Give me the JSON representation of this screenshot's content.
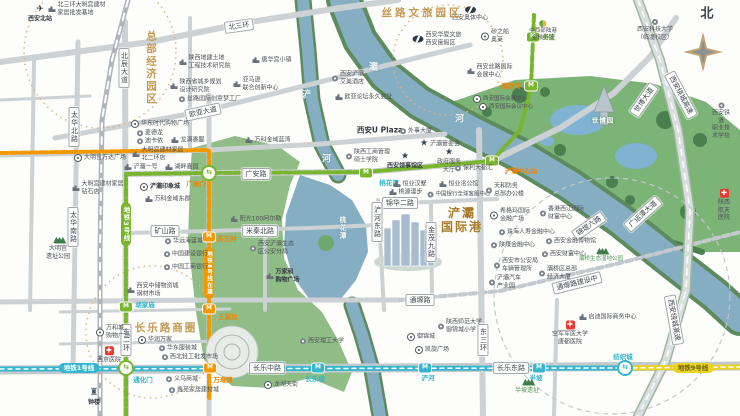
{
  "map": {
    "title_labels": {
      "hq": "总部经济园区",
      "silk": "丝路文旅园区",
      "port": "浐灞\n国际港",
      "changle": "长乐路商圈",
      "expo": "世博园",
      "north": "北"
    },
    "colors": {
      "gold": "#c49a55",
      "port_gold": "#a87b28",
      "line1": "#36b6ce",
      "line3": "#79b52d",
      "line8": "#f39800",
      "line9": "#ead31d",
      "teal": "#2eb4c9",
      "orange": "#f08300",
      "green_text": "#4f9552"
    },
    "metro_lines": [
      {
        "name": "地铁1号线",
        "color": "#36b6ce",
        "fg": "#fff",
        "dash": false,
        "w": 5,
        "path": [
          [
            0,
            369
          ],
          [
            625,
            368
          ]
        ],
        "pill": {
          "x": 79,
          "y": 368
        }
      },
      {
        "name": "地铁9号线",
        "color": "#ead31d",
        "fg": "#6a6014",
        "dash": false,
        "w": 5,
        "path": [
          [
            625,
            368
          ],
          [
            740,
            367
          ]
        ],
        "pill": {
          "x": 693,
          "y": 368
        }
      },
      {
        "name": "地铁3号线",
        "color": "#79b52d",
        "fg": "#fff",
        "dash": true,
        "w": 4,
        "path": [
          [
            126,
            416
          ],
          [
            126,
            174
          ],
          [
            209,
            173
          ],
          [
            366,
            172
          ],
          [
            492,
            161
          ],
          [
            520,
            130
          ],
          [
            531,
            87
          ],
          [
            534,
            15
          ]
        ],
        "pill": {
          "x": 126,
          "y": 224,
          "vert": true
        }
      },
      {
        "name": "地铁8号线在建",
        "color": "#f39800",
        "fg": "#fff",
        "dash": true,
        "w": 4,
        "path": [
          [
            0,
            153
          ],
          [
            209,
            150
          ],
          [
            209,
            398
          ]
        ],
        "pill": {
          "x": 209,
          "y": 273,
          "vert": true,
          "fs": 5.5
        }
      }
    ],
    "stations": [
      {
        "x": 126,
        "y": 368,
        "kind": "x",
        "color": "#79b52d",
        "label": "通化门",
        "lx": 143,
        "ly": 379,
        "lc": "#2eb4c9"
      },
      {
        "x": 126,
        "y": 307,
        "kind": "m",
        "color": "#79b52d",
        "label": "胡家庙",
        "lx": 145,
        "ly": 304,
        "lc": "#2eb4c9"
      },
      {
        "x": 209,
        "y": 173,
        "kind": "x",
        "color": "#79b52d",
        "label": "广泰门",
        "lx": 196,
        "ly": 183,
        "lc": "#f08300"
      },
      {
        "x": 366,
        "y": 173,
        "kind": "m",
        "color": "#79b52d",
        "label": "桃花潭",
        "lx": 389,
        "ly": 182,
        "lc": "#2eb4c9"
      },
      {
        "x": 492,
        "y": 161,
        "kind": "m",
        "color": "#79b52d",
        "label": "浐灞中心站",
        "lx": 521,
        "ly": 170,
        "lc": "#f08300"
      },
      {
        "x": 531,
        "y": 86,
        "kind": "m",
        "color": "#79b52d",
        "label": "香湖湾",
        "lx": 511,
        "ly": 85,
        "lc": "#f08300"
      },
      {
        "x": 533,
        "y": 37,
        "kind": "m",
        "color": "#79b52d",
        "label": "务庄",
        "lx": 549,
        "ly": 36,
        "lc": "#67a23c"
      },
      {
        "x": 209,
        "y": 237,
        "kind": "m",
        "color": "#f39800",
        "label": "苏王村",
        "lx": 227,
        "ly": 238,
        "lc": "#f08300"
      },
      {
        "x": 209,
        "y": 309,
        "kind": "m",
        "color": "#f39800",
        "label": "王家坟",
        "lx": 228,
        "ly": 316,
        "lc": "#f08300"
      },
      {
        "x": 210,
        "y": 368,
        "kind": "m",
        "color": "#f39800",
        "label": "万寿路",
        "lx": 223,
        "ly": 379,
        "lc": "#f08300"
      },
      {
        "x": 318,
        "y": 368,
        "kind": "m",
        "color": "#36b6ce",
        "label": "长乐坡",
        "lx": 315,
        "ly": 378,
        "lc": "#2eb4c9"
      },
      {
        "x": 425,
        "y": 368,
        "kind": "m",
        "color": "#36b6ce",
        "label": "浐河",
        "lx": 428,
        "ly": 377,
        "lc": "#2eb4c9"
      },
      {
        "x": 539,
        "y": 368,
        "kind": "m",
        "color": "#36b6ce",
        "label": "半坡",
        "lx": 536,
        "ly": 377,
        "lc": "#2eb4c9"
      },
      {
        "x": 625,
        "y": 368,
        "kind": "x",
        "color": "#36b6ce",
        "label": "纺织城",
        "lx": 623,
        "ly": 356,
        "lc": "#2eb4c9"
      }
    ],
    "road_signs": [
      {
        "x": 239,
        "y": 26,
        "t": "北三环",
        "rot": -8
      },
      {
        "x": 124,
        "y": 68,
        "t": "北辰大道",
        "vert": true
      },
      {
        "x": 74,
        "y": 127,
        "t": "太华北路",
        "vert": true
      },
      {
        "x": 203,
        "y": 112,
        "t": "欧亚大道",
        "rot": -12
      },
      {
        "x": 256,
        "y": 174,
        "t": "广安路"
      },
      {
        "x": 73,
        "y": 227,
        "t": "太华南路",
        "vert": true
      },
      {
        "x": 165,
        "y": 231,
        "t": "矿山路"
      },
      {
        "x": 260,
        "y": 231,
        "t": "米秦北路"
      },
      {
        "x": 400,
        "y": 203,
        "t": "锦华二路"
      },
      {
        "x": 377,
        "y": 222,
        "t": "浐河东路",
        "vert": true
      },
      {
        "x": 431,
        "y": 242,
        "t": "金茂九路",
        "vert": true
      },
      {
        "x": 126,
        "y": 340,
        "t": "东二环",
        "vert": true
      },
      {
        "x": 267,
        "y": 368,
        "t": "长乐中路"
      },
      {
        "x": 511,
        "y": 368,
        "t": "长乐东路"
      },
      {
        "x": 483,
        "y": 340,
        "t": "东三环",
        "vert": true
      },
      {
        "x": 420,
        "y": 300,
        "t": "通塬路"
      },
      {
        "x": 577,
        "y": 283,
        "t": "通塬路建设中",
        "rot": -14
      },
      {
        "x": 643,
        "y": 214,
        "t": "广运潭大道",
        "rot": -42
      },
      {
        "x": 589,
        "y": 226,
        "t": "锦堤六路",
        "rot": -35
      },
      {
        "x": 644,
        "y": 100,
        "t": "世博大道",
        "rot": -55
      },
      {
        "x": 681,
        "y": 95,
        "t": "西安绕城高速",
        "rot": 62
      },
      {
        "x": 674,
        "y": 320,
        "t": "西安绕城高速",
        "rot": 80
      }
    ],
    "river_labels": [
      {
        "x": 307,
        "y": 94,
        "t": "浐"
      },
      {
        "x": 327,
        "y": 158,
        "t": "河"
      },
      {
        "x": 374,
        "y": 66,
        "t": "灞"
      },
      {
        "x": 460,
        "y": 118,
        "t": "河"
      },
      {
        "x": 343,
        "y": 228,
        "t": "桃花潭",
        "vert": true,
        "fs": 7
      }
    ],
    "pois": [
      {
        "x": 40,
        "y": 14,
        "ic": "train",
        "t": "西安北站",
        "st": 1,
        "b": 1
      },
      {
        "x": 77,
        "y": 9,
        "ic": "bld",
        "t": "北三环大明宫建材\n家居批发基地"
      },
      {
        "x": 205,
        "y": 62,
        "ic": "bld",
        "t": "陕西地建土地\n工程技术研究院"
      },
      {
        "x": 272,
        "y": 60,
        "ic": "bld",
        "t": "唐华宫小镇"
      },
      {
        "x": 196,
        "y": 86,
        "ic": "bld",
        "t": "陕西省城乡规划\n设计研究院"
      },
      {
        "x": 210,
        "y": 99,
        "ic": "circ",
        "t": "丝路国际创意梦工厂"
      },
      {
        "x": 256,
        "y": 84,
        "ic": "bld",
        "t": "亚马逊\n联合创新中心"
      },
      {
        "x": 160,
        "y": 124,
        "ic": "ring",
        "t": "华东时代购物广场"
      },
      {
        "x": 150,
        "y": 133,
        "ic": "circ",
        "t": "麦德龙"
      },
      {
        "x": 150,
        "y": 141,
        "ic": "circ",
        "t": "迪卡侬"
      },
      {
        "x": 188,
        "y": 140,
        "ic": "bld",
        "t": "龙湖香醍"
      },
      {
        "x": 100,
        "y": 158,
        "ic": "ring",
        "t": "大明宫万达广场"
      },
      {
        "x": 158,
        "y": 154,
        "ic": "bld",
        "t": "大明宫建材家居\n北二环店"
      },
      {
        "x": 141,
        "y": 167,
        "ic": "bld",
        "t": "浐灞一号"
      },
      {
        "x": 182,
        "y": 167,
        "ic": "bld",
        "t": "湖畔嘉园"
      },
      {
        "x": 268,
        "y": 140,
        "ic": "bld",
        "t": "万科金域蓝湾"
      },
      {
        "x": 98,
        "y": 188,
        "ic": "bld",
        "t": "大明宫建材家居\n钻石店"
      },
      {
        "x": 160,
        "y": 187,
        "ic": "ring",
        "t": "浐灞印象城",
        "b": 1
      },
      {
        "x": 168,
        "y": 199,
        "ic": "bld",
        "t": "万科金域东郡"
      },
      {
        "x": 58,
        "y": 248,
        "ic": "trees",
        "t": "大明宫\n遗址公园",
        "st": 1
      },
      {
        "x": 184,
        "y": 241,
        "ic": "circ",
        "t": "华远海蓝城"
      },
      {
        "x": 186,
        "y": 254,
        "ic": "circ",
        "t": "中国建设银行"
      },
      {
        "x": 186,
        "y": 267,
        "ic": "circ",
        "t": "中国工商银行"
      },
      {
        "x": 256,
        "y": 219,
        "ic": "bld",
        "t": "阳光100阿尔勒"
      },
      {
        "x": 272,
        "y": 248,
        "ic": "circ",
        "t": "西安浐灞生态\n区公安分局"
      },
      {
        "x": 283,
        "y": 276,
        "ic": "bld",
        "t": "万家和\n购物广场",
        "b": 1
      },
      {
        "x": 153,
        "y": 290,
        "ic": "bld",
        "t": "西安中储物资城\n钢材市场"
      },
      {
        "x": 113,
        "y": 332,
        "ic": "ring",
        "t": "万和城\n购物广场"
      },
      {
        "x": 109,
        "y": 355,
        "ic": "cross",
        "t": "西京医院",
        "st": 1
      },
      {
        "x": 155,
        "y": 340,
        "ic": "ring",
        "t": "华润万家"
      },
      {
        "x": 178,
        "y": 348,
        "ic": "circ",
        "t": "华东服装城"
      },
      {
        "x": 190,
        "y": 357,
        "ic": "circ",
        "t": "西北轻工批发市场"
      },
      {
        "x": 182,
        "y": 379,
        "ic": "circ",
        "t": "义乌商城"
      },
      {
        "x": 194,
        "y": 390,
        "ic": "circ",
        "t": "鑫苑家居建材城"
      },
      {
        "x": 94,
        "y": 397,
        "ic": "bell",
        "t": "钟楼",
        "st": 1,
        "b": 1
      },
      {
        "x": 281,
        "y": 385,
        "ic": "ring",
        "t": "龙湖天街"
      },
      {
        "x": 322,
        "y": 341,
        "ic": "circ",
        "t": "西安理工大学"
      },
      {
        "x": 348,
        "y": 78,
        "ic": "circ",
        "t": "西安浐灞\n艾美酒店"
      },
      {
        "x": 364,
        "y": 97,
        "ic": "bld",
        "t": "欧亚论坛永久会址"
      },
      {
        "x": 380,
        "y": 130,
        "ic": "none",
        "t": "西安U Plaza",
        "b": 1,
        "fs": 7.5
      },
      {
        "x": 416,
        "y": 131,
        "ic": "circ",
        "t": "外事大厦"
      },
      {
        "x": 440,
        "y": 144,
        "ic": "star",
        "t": "浐灞管委会"
      },
      {
        "x": 368,
        "y": 156,
        "ic": "circ",
        "t": "陕西工商管理\n硕士学院"
      },
      {
        "x": 405,
        "y": 161,
        "ic": "star",
        "t": "西安领事馆区",
        "st": 1,
        "b": 1
      },
      {
        "x": 449,
        "y": 161,
        "ic": "star",
        "t": "政府服务\n大厅",
        "st": 1
      },
      {
        "x": 474,
        "y": 168,
        "ic": "circ",
        "t": "保利大都汇"
      },
      {
        "x": 410,
        "y": 184,
        "ic": "bld",
        "t": "恒业汉墅"
      },
      {
        "x": 459,
        "y": 184,
        "ic": "bld",
        "t": "恒业洺公馆"
      },
      {
        "x": 406,
        "y": 192,
        "ic": "bld",
        "t": "桃源漫步"
      },
      {
        "x": 459,
        "y": 195,
        "ic": "circ",
        "t": "中国银行全球客服中心",
        "fs": 5.5
      },
      {
        "x": 505,
        "y": 190,
        "ic": "circ",
        "t": "天和防务\n总部办公楼"
      },
      {
        "x": 510,
        "y": 215,
        "ic": "ring",
        "t": "希格玛国际\n金融广场"
      },
      {
        "x": 562,
        "y": 213,
        "ic": "circ",
        "t": "香港西江国际\n财富中心"
      },
      {
        "x": 527,
        "y": 232,
        "ic": "circ",
        "t": "珠海人寿金融中心"
      },
      {
        "x": 513,
        "y": 245,
        "ic": "circ",
        "t": "陕煤金融中心"
      },
      {
        "x": 571,
        "y": 241,
        "ic": "circ",
        "t": "西安金融博物馆"
      },
      {
        "x": 564,
        "y": 254,
        "ic": "circ",
        "t": "西安财富中心"
      },
      {
        "x": 516,
        "y": 265,
        "ic": "circ",
        "t": "西安市公安局\n车辆管理所"
      },
      {
        "x": 505,
        "y": 282,
        "ic": "circ",
        "t": "浐灞汽车\n产业园"
      },
      {
        "x": 558,
        "y": 273,
        "ic": "circ",
        "t": "灞桥区总部\n经济大厦"
      },
      {
        "x": 601,
        "y": 255,
        "ic": "trees",
        "t": "灞桥生态湿地公园",
        "st": 1,
        "c": "#4f9552",
        "fs": 5.5
      },
      {
        "x": 608,
        "y": 317,
        "ic": "bld",
        "t": "启迪国际商务中心"
      },
      {
        "x": 570,
        "y": 333,
        "ic": "cross",
        "t": "空军军医大学\n唐都医院",
        "st": 1
      },
      {
        "x": 460,
        "y": 326,
        "ic": "circ",
        "t": "陕西师范大学\n御锦城小学"
      },
      {
        "x": 421,
        "y": 337,
        "ic": "ring",
        "t": "御锦城"
      },
      {
        "x": 432,
        "y": 350,
        "ic": "ring",
        "t": "凯旋广场"
      },
      {
        "x": 527,
        "y": 386,
        "ic": "trees",
        "t": "半坡遗址",
        "st": 1,
        "c": "#4f9552"
      },
      {
        "x": 724,
        "y": 205,
        "ic": "cross",
        "t": "陕西\n航天医院",
        "st": 1
      },
      {
        "x": 721,
        "y": 121,
        "ic": "circ",
        "t": "西安铁道\n职业技术学校",
        "st": 1
      },
      {
        "x": 655,
        "y": 30,
        "ic": "circ",
        "t": "西安科技大学\n（临潼校区）",
        "st": 1
      },
      {
        "x": 470,
        "y": 14,
        "ic": "logo",
        "t": "西安奥体中心",
        "st": 1
      },
      {
        "x": 437,
        "y": 39,
        "ic": "logo",
        "t": "西安华夏文旅\n西安度假区"
      },
      {
        "x": 543,
        "y": 31,
        "ic": "dlogo",
        "t": "中西部陆港\n金融小镇",
        "st": 1,
        "fs": 5.5
      },
      {
        "x": 495,
        "y": 36,
        "ic": "ring",
        "t": "砂之船\n奥莱"
      },
      {
        "x": 490,
        "y": 71,
        "ic": "bld",
        "t": "西安丝路国际\n会展中心"
      },
      {
        "x": 500,
        "y": 99,
        "ic": "ring",
        "t": "西安国际会展中心",
        "fs": 5.5
      },
      {
        "x": 506,
        "y": 107,
        "ic": "ring",
        "t": "西安国际会议中心",
        "fs": 5.5
      }
    ]
  }
}
